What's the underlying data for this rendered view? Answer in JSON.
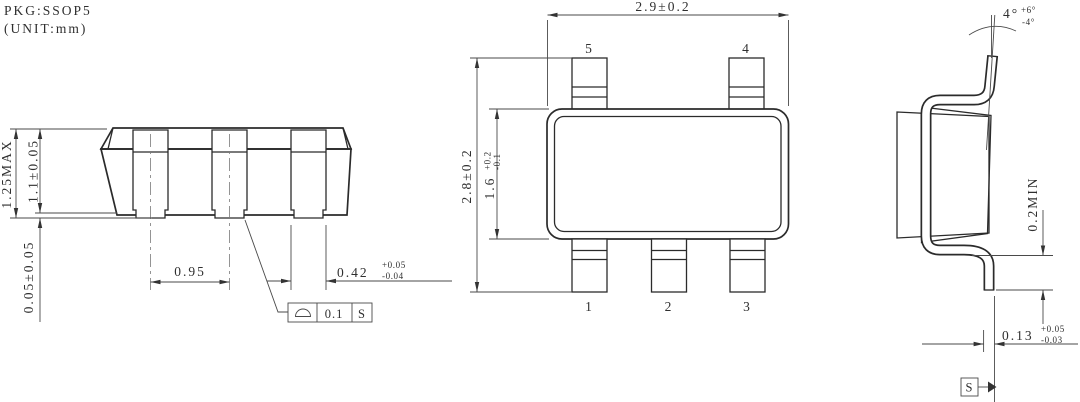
{
  "header": {
    "pkg_label": "PKG:SSOP5",
    "unit_label": "(UNIT:mm)"
  },
  "front_view": {
    "dim_total_height": "1.25MAX",
    "dim_body_height": "1.1±0.05",
    "dim_standoff": "0.05±0.05",
    "dim_lead_pitch": "0.95",
    "dim_lead_width": "0.42",
    "dim_lead_width_tol_plus": "+0.05",
    "dim_lead_width_tol_minus": "-0.04",
    "fcf_symbol": "profile-of-surface (seating plane)",
    "fcf_tolerance": "0.1",
    "fcf_datum": "S"
  },
  "top_view": {
    "dim_body_width": "2.9±0.2",
    "dim_overall_length": "2.8±0.2",
    "dim_body_length": "1.6",
    "dim_body_length_tol_plus": "+0.2",
    "dim_body_length_tol_minus": "-0.1",
    "pin_labels_top": [
      "5",
      "4"
    ],
    "pin_labels_bottom": [
      "1",
      "2",
      "3"
    ]
  },
  "side_view": {
    "lead_angle": "4°",
    "lead_angle_tol_plus": "+6°",
    "lead_angle_tol_minus": "-4°",
    "dim_standoff_min": "0.2MIN",
    "dim_lead_thickness": "0.13",
    "dim_lead_thickness_tol_plus": "+0.05",
    "dim_lead_thickness_tol_minus": "-0.03",
    "datum_label": "S"
  },
  "colors": {
    "line": "#2b2b2b",
    "background": "#ffffff"
  }
}
